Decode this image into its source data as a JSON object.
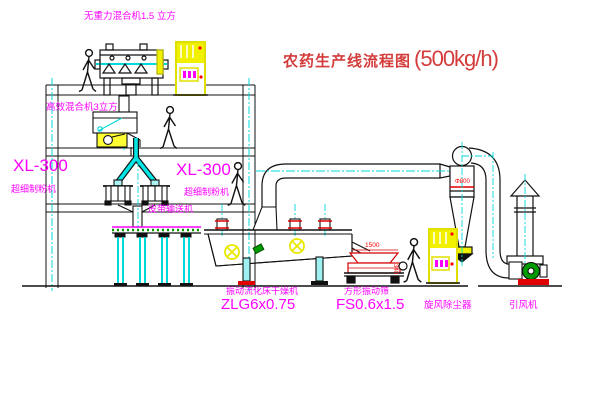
{
  "title": {
    "name": "农药生产线流程图",
    "capacity": "(500kg/h)"
  },
  "colors": {
    "label_magenta": "#ff00ff",
    "title_red": "#d43c3c",
    "dim_red": "#ff0000",
    "centerline_cyan": "#00d9d9",
    "cabinet_yellow": "#f0f000",
    "machine_green": "#009b00",
    "line_black": "#000000"
  },
  "equipment": {
    "mixer_top": {
      "label": "无重力混合机1.5 立方"
    },
    "mixer_mid": {
      "label": "高效混合机3立方"
    },
    "mill_left": {
      "model": "XL-300",
      "label": "超细制粉机"
    },
    "mill_right": {
      "model": "XL-300",
      "label": "超细制粉机"
    },
    "conveyor": {
      "label": "皮带输送机"
    },
    "dryer": {
      "label": "振动流化床干燥机",
      "model": "ZLG6x0.75"
    },
    "screen": {
      "label": "方形振动筛",
      "model": "FS0.6x1.5"
    },
    "cyclone": {
      "label": "旋风除尘器",
      "dim": "Φ800"
    },
    "fan": {
      "label": "引风机"
    },
    "dims": {
      "screen_length": "1500",
      "screen_height": "340"
    }
  }
}
